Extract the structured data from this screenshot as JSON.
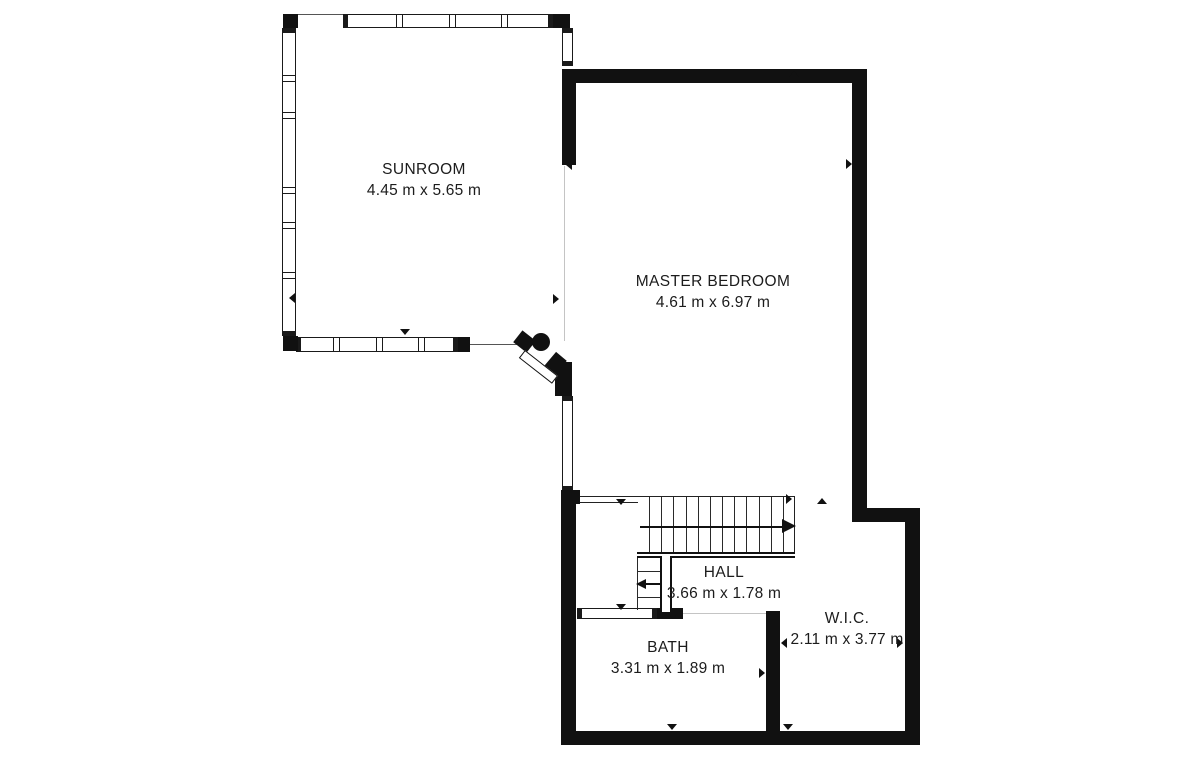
{
  "page": {
    "background": "#ffffff"
  },
  "colors": {
    "wall": "#111111",
    "line": "#222222",
    "faint": "#c4c4c4",
    "stub": "#555555",
    "text": "#1c1c1c"
  },
  "rooms": [
    {
      "id": "sunroom",
      "name": "SUNROOM",
      "dims": "4.45 m x 5.65 m",
      "cx": 424,
      "cy": 180
    },
    {
      "id": "master-bedroom",
      "name": "MASTER BEDROOM",
      "dims": "4.61 m x 6.97 m",
      "cx": 713,
      "cy": 292
    },
    {
      "id": "hall",
      "name": "HALL",
      "dims": "3.66 m x 1.78 m",
      "cx": 724,
      "cy": 583
    },
    {
      "id": "bath",
      "name": "BATH",
      "dims": "3.31 m x 1.89 m",
      "cx": 668,
      "cy": 658
    },
    {
      "id": "wic",
      "name": "W.I.C.",
      "dims": "2.11 m x 3.77 m",
      "cx": 847,
      "cy": 629
    }
  ],
  "plan": {
    "walls": [
      {
        "name": "sunroom-corner-tl",
        "x": 283,
        "y": 14,
        "w": 15,
        "h": 14
      },
      {
        "name": "sunroom-corner-tr",
        "x": 553,
        "y": 14,
        "w": 17,
        "h": 14
      },
      {
        "name": "sunroom-corner-bl",
        "x": 283,
        "y": 336,
        "w": 15,
        "h": 15
      },
      {
        "name": "sunroom-window-end",
        "x": 458,
        "y": 337,
        "w": 12,
        "h": 15
      },
      {
        "name": "master-top-wall",
        "x": 562,
        "y": 69,
        "w": 305,
        "h": 14
      },
      {
        "name": "master-west-wall",
        "x": 562,
        "y": 69,
        "w": 14,
        "h": 96
      },
      {
        "name": "master-east-wall",
        "x": 852,
        "y": 69,
        "w": 15,
        "h": 453
      },
      {
        "name": "step-wall",
        "x": 852,
        "y": 508,
        "w": 68,
        "h": 14
      },
      {
        "name": "wic-east-wall",
        "x": 905,
        "y": 508,
        "w": 15,
        "h": 237
      },
      {
        "name": "south-wall",
        "x": 561,
        "y": 731,
        "w": 359,
        "h": 14
      },
      {
        "name": "hall-west-wall",
        "x": 561,
        "y": 490,
        "w": 15,
        "h": 245
      },
      {
        "name": "hall-corner-block",
        "x": 561,
        "y": 490,
        "w": 19,
        "h": 14
      },
      {
        "name": "bath-top-wall-segment",
        "x": 657,
        "y": 608,
        "w": 26,
        "h": 11
      },
      {
        "name": "bath-east-wall",
        "x": 766,
        "y": 611,
        "w": 14,
        "h": 124
      },
      {
        "name": "door-jamb",
        "x": 555,
        "y": 362,
        "w": 17,
        "h": 34
      },
      {
        "name": "door-jamb-angled",
        "x": 548,
        "y": 354,
        "w": 14,
        "h": 20,
        "rot": 40
      },
      {
        "name": "door-hinge-block",
        "x": 516,
        "y": 334,
        "w": 17,
        "h": 15,
        "rot": 38
      }
    ],
    "thin_lines": [
      {
        "name": "sunroom-top-edge",
        "x": 290,
        "y": 14,
        "w": 54,
        "h": 1,
        "color": "#555555"
      },
      {
        "name": "door-opening-line",
        "x": 470,
        "y": 344,
        "w": 47,
        "h": 1,
        "color": "#555555"
      },
      {
        "name": "master-open-boundary",
        "x": 564,
        "y": 166,
        "w": 1,
        "h": 175,
        "color": "#c4c4c4"
      },
      {
        "name": "hall-top-line",
        "x": 577,
        "y": 496,
        "w": 218,
        "h": 1,
        "color": "#222222"
      },
      {
        "name": "hall-top-line-2",
        "x": 577,
        "y": 502,
        "w": 61,
        "h": 1,
        "color": "#222222"
      },
      {
        "name": "stair-right-edge",
        "x": 794,
        "y": 497,
        "w": 1,
        "h": 59,
        "color": "#222222"
      },
      {
        "name": "bath-door-opening",
        "x": 683,
        "y": 613,
        "w": 83,
        "h": 1,
        "color": "#c4c4c4"
      }
    ],
    "windows": [
      {
        "name": "sunroom-window-top",
        "x": 343,
        "y": 14,
        "w": 210,
        "h": 14,
        "orient": "h",
        "mullions": [
          52,
          105,
          157
        ]
      },
      {
        "name": "sunroom-window-left",
        "x": 282,
        "y": 28,
        "w": 14,
        "h": 308,
        "orient": "v",
        "mullions": [
          46,
          83,
          158,
          193,
          243
        ]
      },
      {
        "name": "sunroom-window-right",
        "x": 562,
        "y": 28,
        "w": 11,
        "h": 38,
        "orient": "v",
        "mullions": []
      },
      {
        "name": "sunroom-window-bottom",
        "x": 296,
        "y": 337,
        "w": 162,
        "h": 15,
        "orient": "h",
        "mullions": [
          36,
          79,
          121
        ]
      },
      {
        "name": "master-west-window",
        "x": 562,
        "y": 396,
        "w": 11,
        "h": 95,
        "orient": "v",
        "mullions": []
      },
      {
        "name": "bath-window",
        "x": 577,
        "y": 608,
        "w": 80,
        "h": 11,
        "orient": "h",
        "mullions": []
      },
      {
        "name": "wic-window",
        "x": 848,
        "y": 732,
        "w": 57,
        "h": 12,
        "orient": "h",
        "mullions": []
      }
    ],
    "stairs": {
      "upper_flight": {
        "x": 637,
        "y": 497,
        "w": 158,
        "h": 55,
        "treads": 12
      },
      "edge": {
        "x": 637,
        "y": 552,
        "w": 158,
        "h": 6
      },
      "lower_flight": {
        "x": 637,
        "y": 558,
        "w": 23,
        "h": 52,
        "tread_ys": [
          571,
          584,
          597
        ]
      },
      "divider": {
        "x": 660,
        "y": 556,
        "w": 12,
        "h": 56
      },
      "arrow_main": {
        "shaft": {
          "x": 640,
          "y": 526,
          "w": 144,
          "h": 2
        },
        "head": {
          "x": 782,
          "y": 519,
          "dir": "right",
          "size": 14
        }
      },
      "arrow_lower": {
        "shaft": {
          "x": 646,
          "y": 583,
          "w": 16,
          "h": 2
        },
        "head": {
          "x": 636,
          "y": 579,
          "dir": "left",
          "size": 10
        }
      }
    },
    "door": {
      "knob": {
        "cx": 541,
        "cy": 342,
        "r": 9
      },
      "leaf": {
        "x": 525,
        "y": 350,
        "len": 42,
        "thick": 10,
        "deg": 38
      }
    },
    "markers": [
      {
        "x": 289,
        "y": 293,
        "dir": "left"
      },
      {
        "x": 553,
        "y": 294,
        "dir": "right"
      },
      {
        "x": 400,
        "y": 329,
        "dir": "down"
      },
      {
        "x": 566,
        "y": 160,
        "dir": "left"
      },
      {
        "x": 789,
        "y": 71,
        "dir": "up"
      },
      {
        "x": 846,
        "y": 159,
        "dir": "right"
      },
      {
        "x": 616,
        "y": 499,
        "dir": "down"
      },
      {
        "x": 786,
        "y": 494,
        "dir": "right"
      },
      {
        "x": 817,
        "y": 498,
        "dir": "up"
      },
      {
        "x": 567,
        "y": 524,
        "dir": "left"
      },
      {
        "x": 781,
        "y": 638,
        "dir": "left"
      },
      {
        "x": 897,
        "y": 638,
        "dir": "right"
      },
      {
        "x": 783,
        "y": 724,
        "dir": "down"
      },
      {
        "x": 667,
        "y": 724,
        "dir": "down"
      },
      {
        "x": 566,
        "y": 668,
        "dir": "left"
      },
      {
        "x": 759,
        "y": 668,
        "dir": "right"
      },
      {
        "x": 616,
        "y": 604,
        "dir": "down"
      },
      {
        "x": 668,
        "y": 613,
        "dir": "down"
      }
    ]
  }
}
